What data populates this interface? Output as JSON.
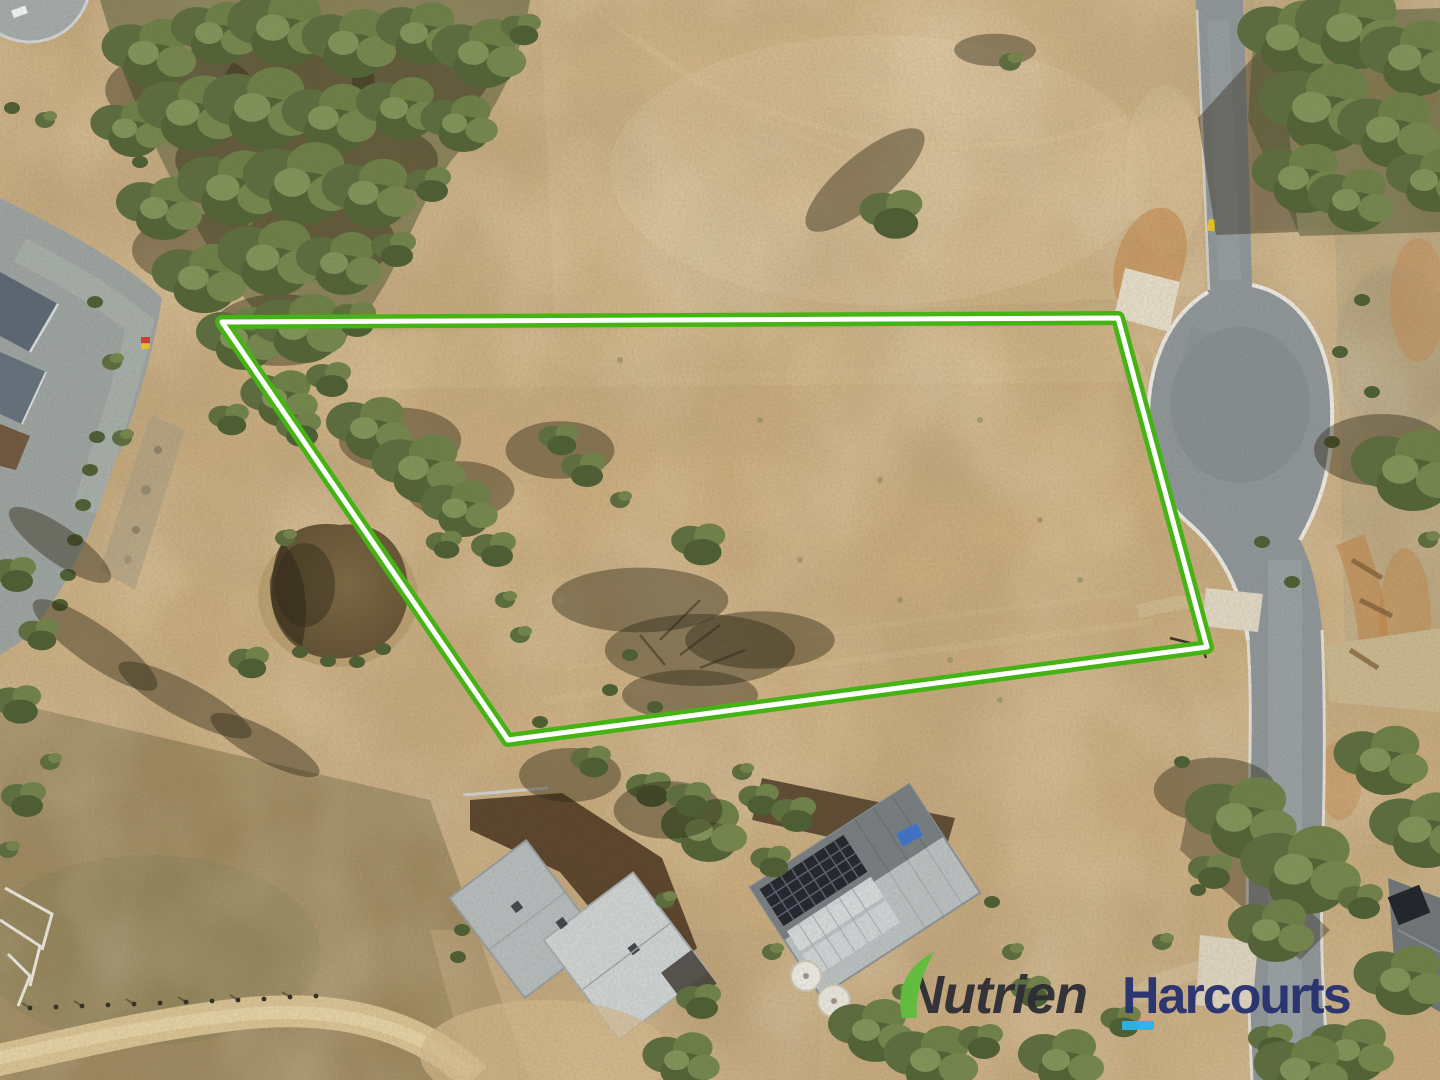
{
  "photo": {
    "kind": "aerial-drone-photograph",
    "description": "Bird's-eye view of a dry rural land parcel outlined in green beside a cul-de-sac court, with a farm dam, tree belt, paddocks and neighbouring homes with solar panels"
  },
  "boundary": {
    "outline_color": "#45b314",
    "casing_color": "#ffffff"
  },
  "watermark": {
    "brand_primary": "Nutrien",
    "brand_secondary": "Harcourts",
    "primary_color": "#2d2d35",
    "secondary_color": "#253070",
    "leaf_color": "#5fbe3c",
    "underline_color": "#2db4e8"
  }
}
